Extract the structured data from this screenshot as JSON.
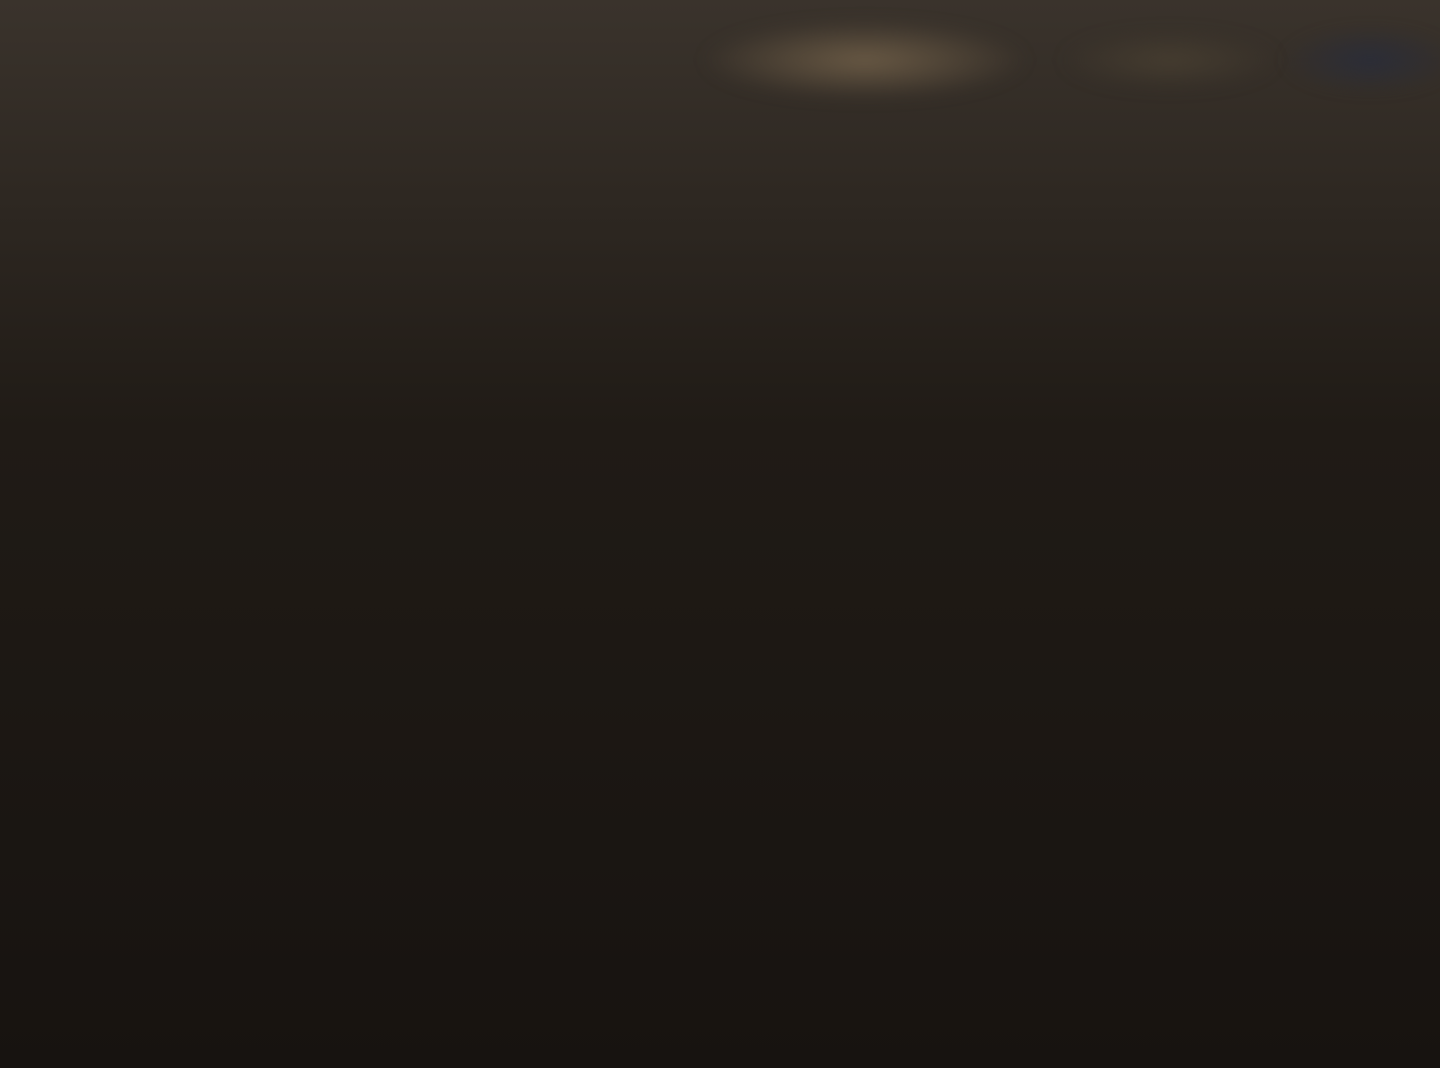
{
  "photo": {
    "credit": "Terrell Soh | SRX PROPERTY"
  },
  "section_xx": {
    "title": "SECTION X -X",
    "scale": "SCALE 1:100",
    "level_label": "1st Storey Level",
    "dim_1500": "1500",
    "door_label_left": "ext'g pvc door",
    "door_label_right": "ext'g pvc door"
  },
  "part_plan": {
    "title_line1": "PART PLAN SHOWING EXISTING FOUNDATION & PROPOSED",
    "title_line2": "SCREEN CHAMBER & GREASE TRAP BASE",
    "scale": "SCALE 1:50",
    "dim_8100": "8100"
  },
  "trimming_detail": {
    "title_line1": "TRIMMING BAR DETAILS FOR NEW FLOOR OPENING",
    "title_line2": "T 1ST STOREY SLAB ONLY",
    "note_hack_recast_1": "EXISTING SLAB TO BE HACKED OFF AND",
    "note_hack_recast_2": "RECASTED WITH GRADE 40 CONCRETE",
    "rebar_top": "2X2T13(T&B)",
    "note_new_opening_1": "EXISTING SLAB TO BE HACKED OFF",
    "note_new_opening_2": "FOR NEW OPENING",
    "rebar_bottom": "2X2T13(T&B)",
    "dim_450": "450",
    "dim_typ": "(TYP)"
  },
  "location_plan": {
    "partial_label": "Lo"
  },
  "certification": {
    "line1": "In accordance with Regulation 9 of the Building Control Regulations,",
    "line2_prefix": "I,",
    "qp_name": "Lee Thou Kint",
    "line2_suffix": "(Qualified Person for Structural Works),",
    "line3": "hereby submit the detailed structural plans and design calculations",
    "line4": "prepared by me and certify that they have been prepared in accordance",
    "line5": "with the provisions of the Building Control Regulations,",
    "line6": "the Building Control Act and any other written law",
    "line7": "pertaining to buildings and construction for the time being in forces.",
    "item2_no": "2.",
    "item2_line1": "I further certify that these detailed structural plans and design",
    "item2_line2": "calculations are in reference to the Project Ref. No.",
    "item2_ref": "B072-0339-1-22-A…",
    "item3_no": "3.",
    "item3_text": "Total number of structural plans submitted :",
    "item3_count": "2."
  },
  "slab_detail": {
    "note_steel_1": "NEW STEEL REINFORCEMENT (4) FOR REINSTATEMENT",
    "note_steel_2": "TO BE SAME SIZE OR BIGGER SIZE THAN THE",
    "note_steel_3": "CUT STEEL FOR THE SLAB",
    "tension_label_1": "TENSION LAP LENGTH",
    "tension_sub_1": "(40d)",
    "tension_label_2": "TENSION LAP LENGTH",
    "tension_sub_2": "(40d)",
    "note_concrete_1": "NEW CONCRETE SLAB TO BE RE-CASTED",
    "note_concrete_2": "WITH CONCRETE GRADE S40",
    "lean_line1": "50mm LEAN",
    "lean_line2": "CONCRETE",
    "faded_note_1": "CUTTING OPENING AT",
    "faded_note_2": "EXISTING SLAB",
    "title": "TYPICAL DETAIL OF SLAB REINSTATEMENT (UNLOADED SLAB)"
  },
  "area_table": {
    "headers": [
      "DESCRIPTION",
      "AREA (M2)",
      "PERCENTAGE(%)"
    ],
    "rows": [
      [
        "KITCHEN",
        "8.02",
        "13.15"
      ],
      [
        "REFRESHMENT",
        "36.68",
        "60.13"
      ],
      [
        "SERVERY",
        "10.14",
        "16.62"
      ],
      [
        "WC & OTHER",
        "6.16",
        "10.10"
      ],
      [
        "TOTAL",
        "61.00",
        "100"
      ],
      [
        "",
        "",
        ""
      ]
    ]
  },
  "plan1": {
    "title": "1ST STOREY LAYOUT PLAN",
    "scale": "SCALE 1:100",
    "unit_no": "#01-06",
    "footway": "FOOTWAY",
    "service_yard": "SERVICE\nYARD",
    "new_kitchen": "NEW\nKITCHEN",
    "servery_area": "SERVERY AREA",
    "refreshment_area": "REFRESHMENT\nAREA",
    "escapeway": "1200mm WIDE ESCAPEWAY",
    "x_marker_top": "X",
    "x_marker_bottom": "X",
    "grease_trap_1": "NEW GREASE TRAP",
    "grease_trap_2": "(Refer to drawing Ref: PUB/SEW/STD041)",
    "ic_1": "Ext'g IC",
    "ic_2": "Ext'g IC",
    "ic_3": "Ext'g IC",
    "upvc_right": "new 100 mm dia UPVC pipe",
    "ann_upvc_1": "new 100 mm dia UPVC pipe",
    "ann_screen_chamber": "NEW SCREEN CHAMBER",
    "ann_upvc_2": "new 100 mm dia UPVC pipe",
    "ann_exhaust_fan": "300 dia exhaust fan",
    "ann_hood_1": "n exhaust hood with self extinguish device",
    "ann_hood_2": "submitted separately",
    "ann_glass_window": "new alum. fix glass window",
    "hw_fire_door_1": "NEW ½ HOUR FIRE",
    "hw_fire_door_2": "RATED DOOR",
    "ann_swing_door": "new swing door",
    "ann_sink_1": "ex'g S/S sink",
    "ann_sink_2": "Ext'g S/S Sink",
    "dims": {
      "d3550": "3550",
      "d2550a": "2550",
      "d2550b": "2550",
      "d2200": "2200",
      "d1100": "1100",
      "d4350": "4350",
      "d900": "900",
      "d1150": "1150",
      "d14000": "14000",
      "d5570": "5570",
      "d4150": "4150",
      "d2000": "2000",
      "d2470": "2470",
      "d1605": "1605",
      "d6100": "6100"
    }
  },
  "plan2": {
    "title": "2ND STOREY LAYOUT PLAN",
    "scale": "SCALE 1:100",
    "master_bedroom": "MASTER\nBEDROOM",
    "kitchen": "KITCHEN",
    "store": "STORE",
    "living": "LIVING",
    "bath_1": "BATH\nW.C",
    "bath_2": "BATH\nW.C",
    "ne_label": "NE",
    "dims": {
      "d6100": "6100",
      "d1300": "1300",
      "d2200": "2200",
      "d2600": "2600",
      "d2550": "2550",
      "d3000": "3000",
      "d7400": "7400"
    }
  }
}
